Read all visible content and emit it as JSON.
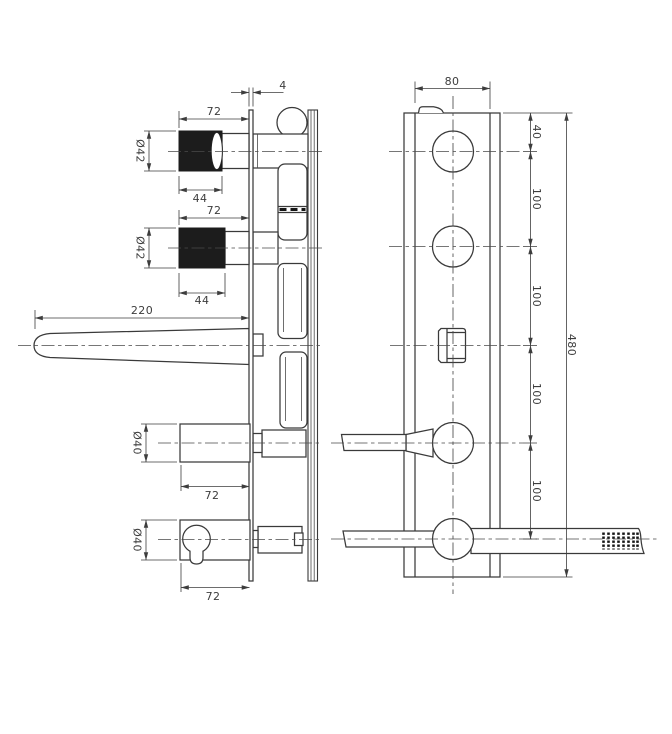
{
  "side_view": {
    "plate_thickness": "4",
    "knob_top": {
      "span": "72",
      "diameter": "Ø42",
      "face": "44"
    },
    "knob_bottom": {
      "span": "72",
      "diameter": "Ø42",
      "face": "44"
    },
    "spout_length": "220",
    "diverter": {
      "diameter": "Ø40",
      "span": "72"
    },
    "handshower": {
      "diameter": "Ø40",
      "span": "72"
    }
  },
  "front_view": {
    "plate_width": "80",
    "top_offset": "40",
    "spacings": [
      "100",
      "100",
      "100",
      "100"
    ],
    "overall_height": "480"
  },
  "colors": {
    "line": "#3a3a3a",
    "dimension": "#3d3d3d",
    "knob_fill": "#1c1c1c",
    "background": "#ffffff"
  }
}
